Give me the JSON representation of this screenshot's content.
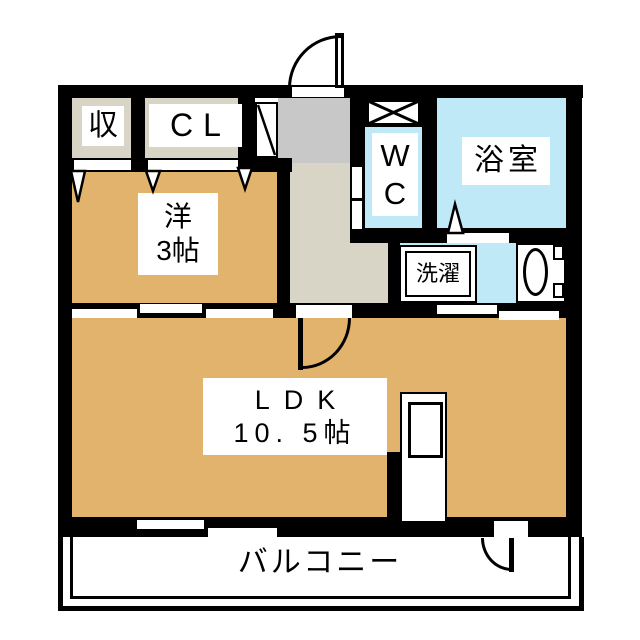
{
  "plan": {
    "rooms": {
      "storage": "収",
      "closet": "CL",
      "western_room": {
        "name": "洋",
        "size": "3帖"
      },
      "wc": {
        "line1": "W",
        "line2": "C"
      },
      "bathroom": "浴室",
      "laundry": "洗濯",
      "ldk": {
        "name": "LDK",
        "size": "10. 5帖"
      },
      "balcony": "バルコニー"
    },
    "colors": {
      "wall": "#000000",
      "room_floor": "#e2b36d",
      "wet_area": "#c0e9f8",
      "entry_gray": "#c8c8c8",
      "hallway": "#d8d4c6",
      "closet_floor": "#d8d4c6",
      "background": "#ffffff"
    }
  }
}
